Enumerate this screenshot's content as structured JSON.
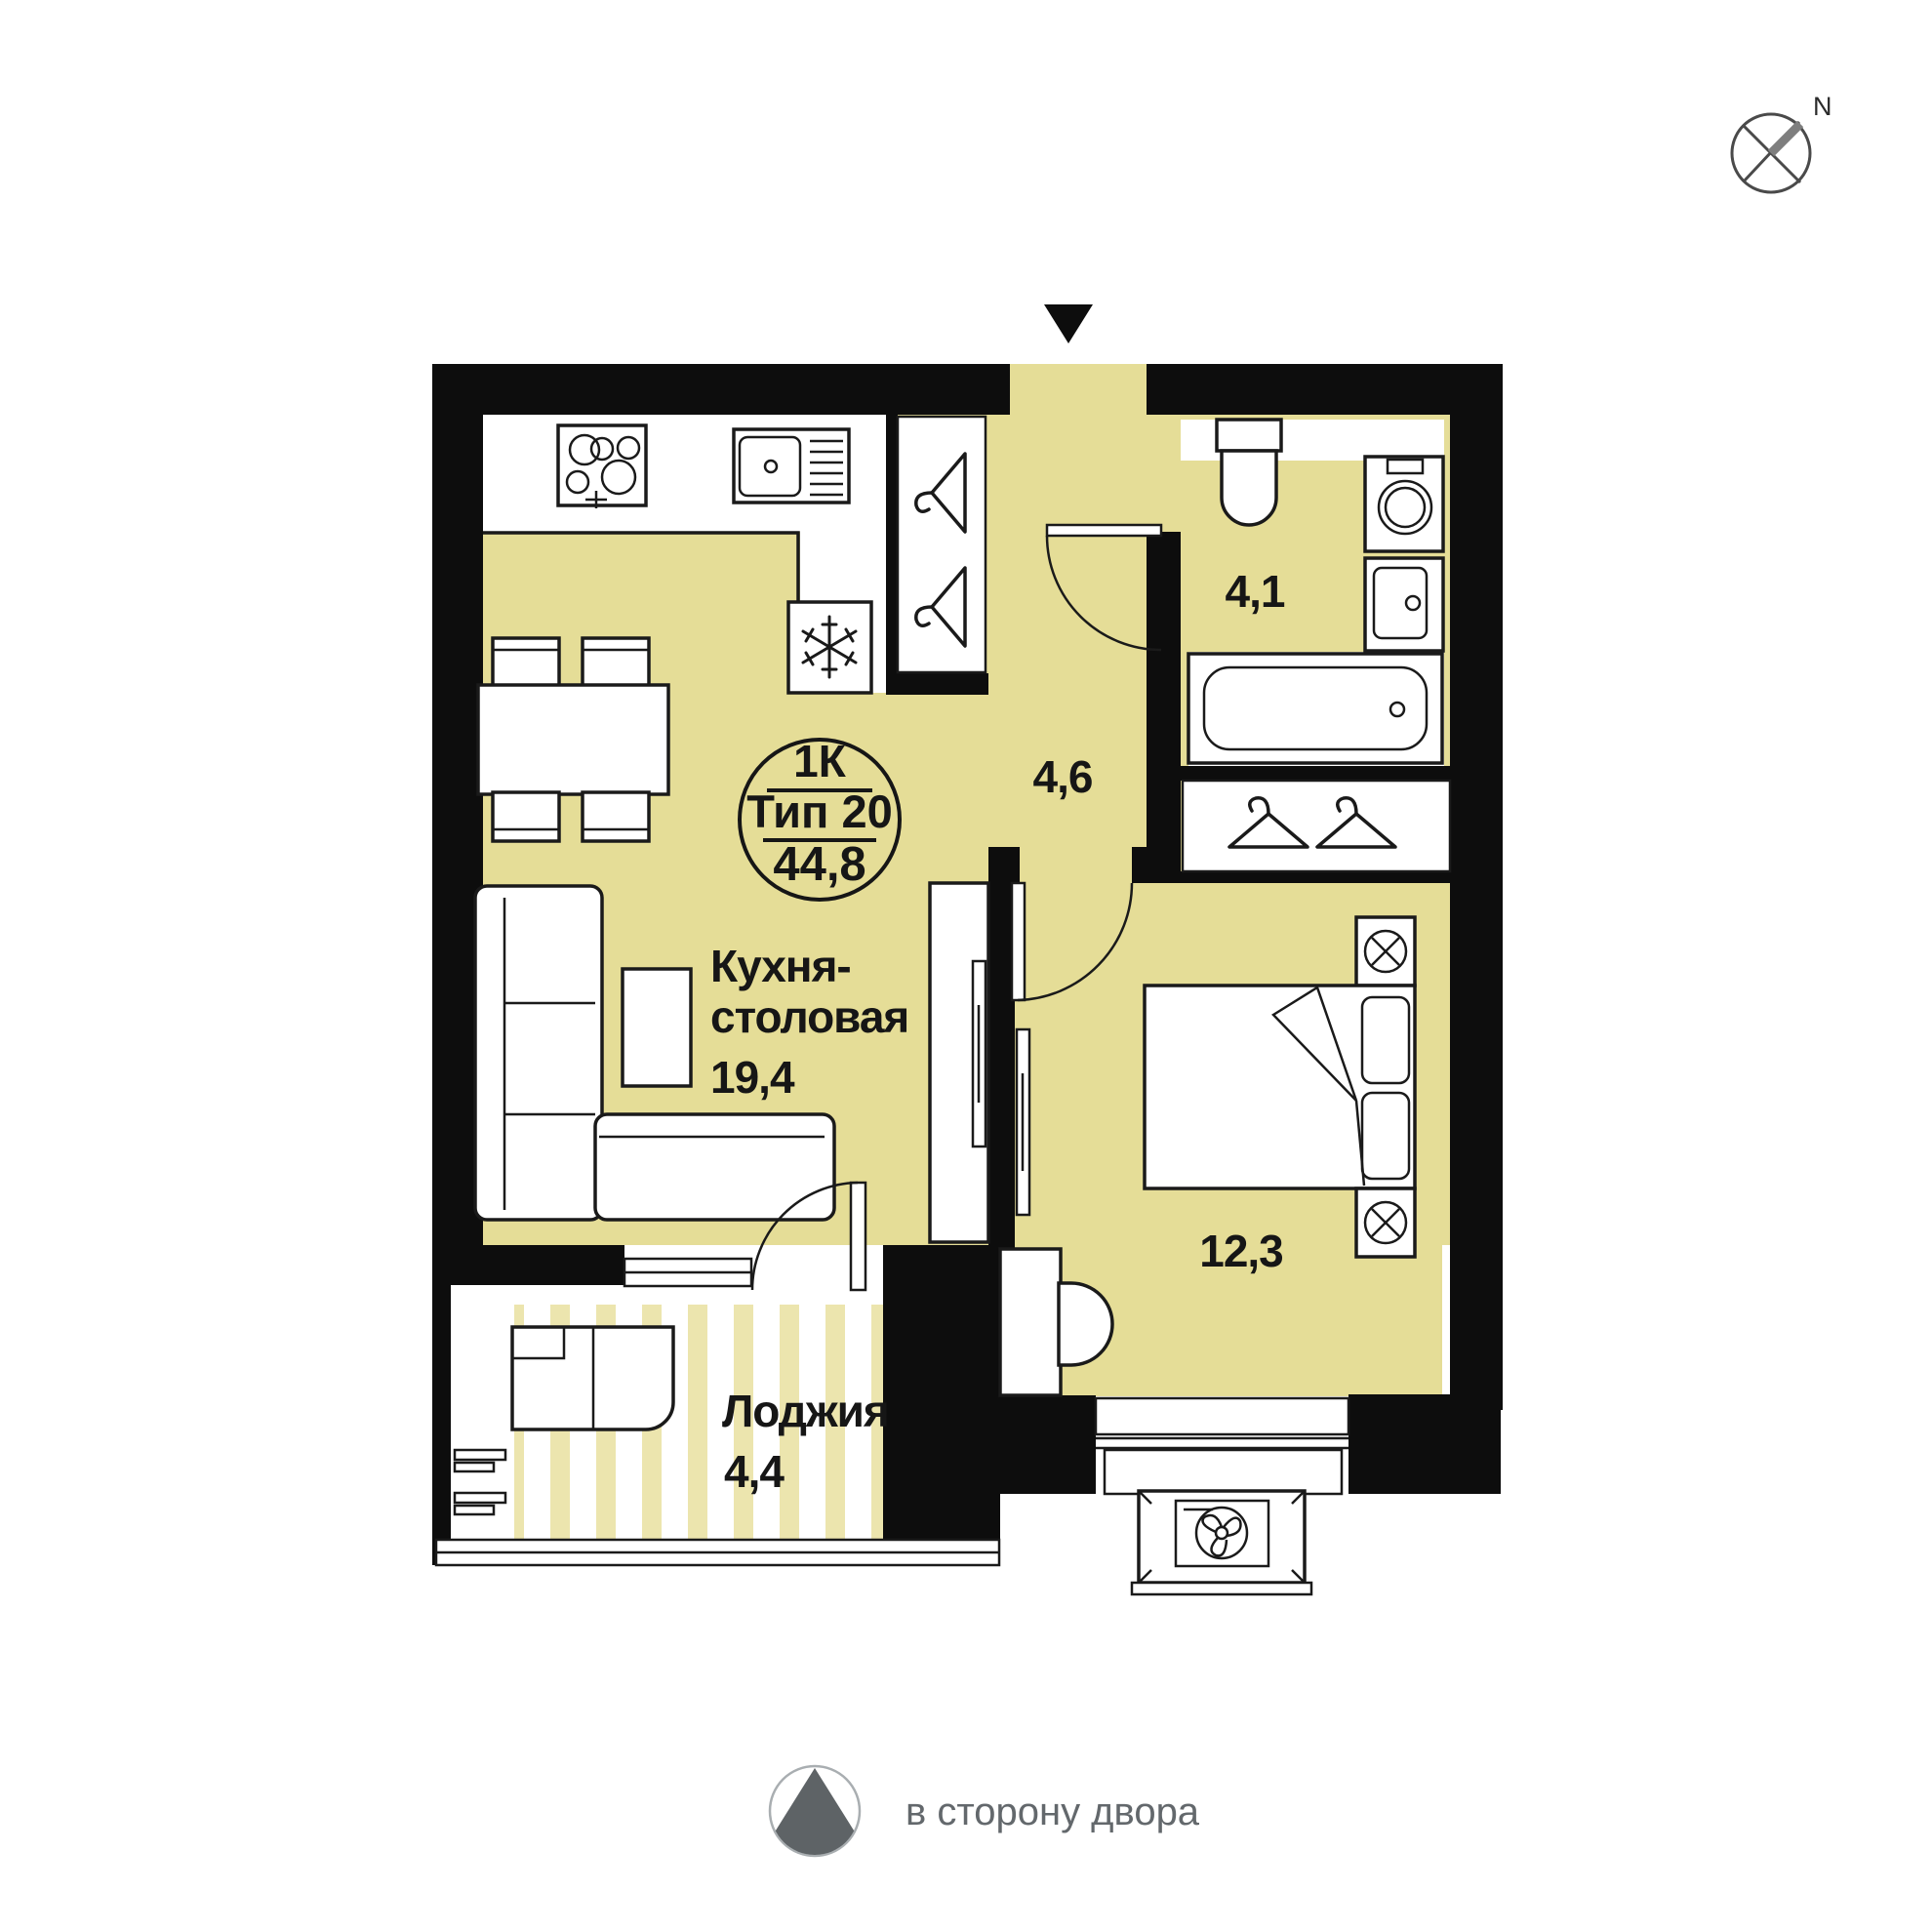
{
  "compass": {
    "label": "N"
  },
  "badge": {
    "line1": "1К",
    "line2": "Тип 20",
    "line3": "44,8"
  },
  "labels": {
    "kitchen_line1": "Кухня-",
    "kitchen_line2": "столовая",
    "kitchen_area": "19,4",
    "hall_area": "4,6",
    "bathroom_area": "4,1",
    "bedroom_area": "12,3",
    "loggia_name": "Лоджия",
    "loggia_area": "4,4"
  },
  "legend": {
    "text": "в сторону двора"
  },
  "colors": {
    "floor": "#E5DD97",
    "stripe": "#ECE5AE",
    "wall": "#0D0D0D",
    "line": "#1A1A1A",
    "legend_text": "#63686C",
    "legend_shape": "#5E6366",
    "compass_line": "#4A4A4A",
    "compass_arm": "#7E7E7E"
  }
}
